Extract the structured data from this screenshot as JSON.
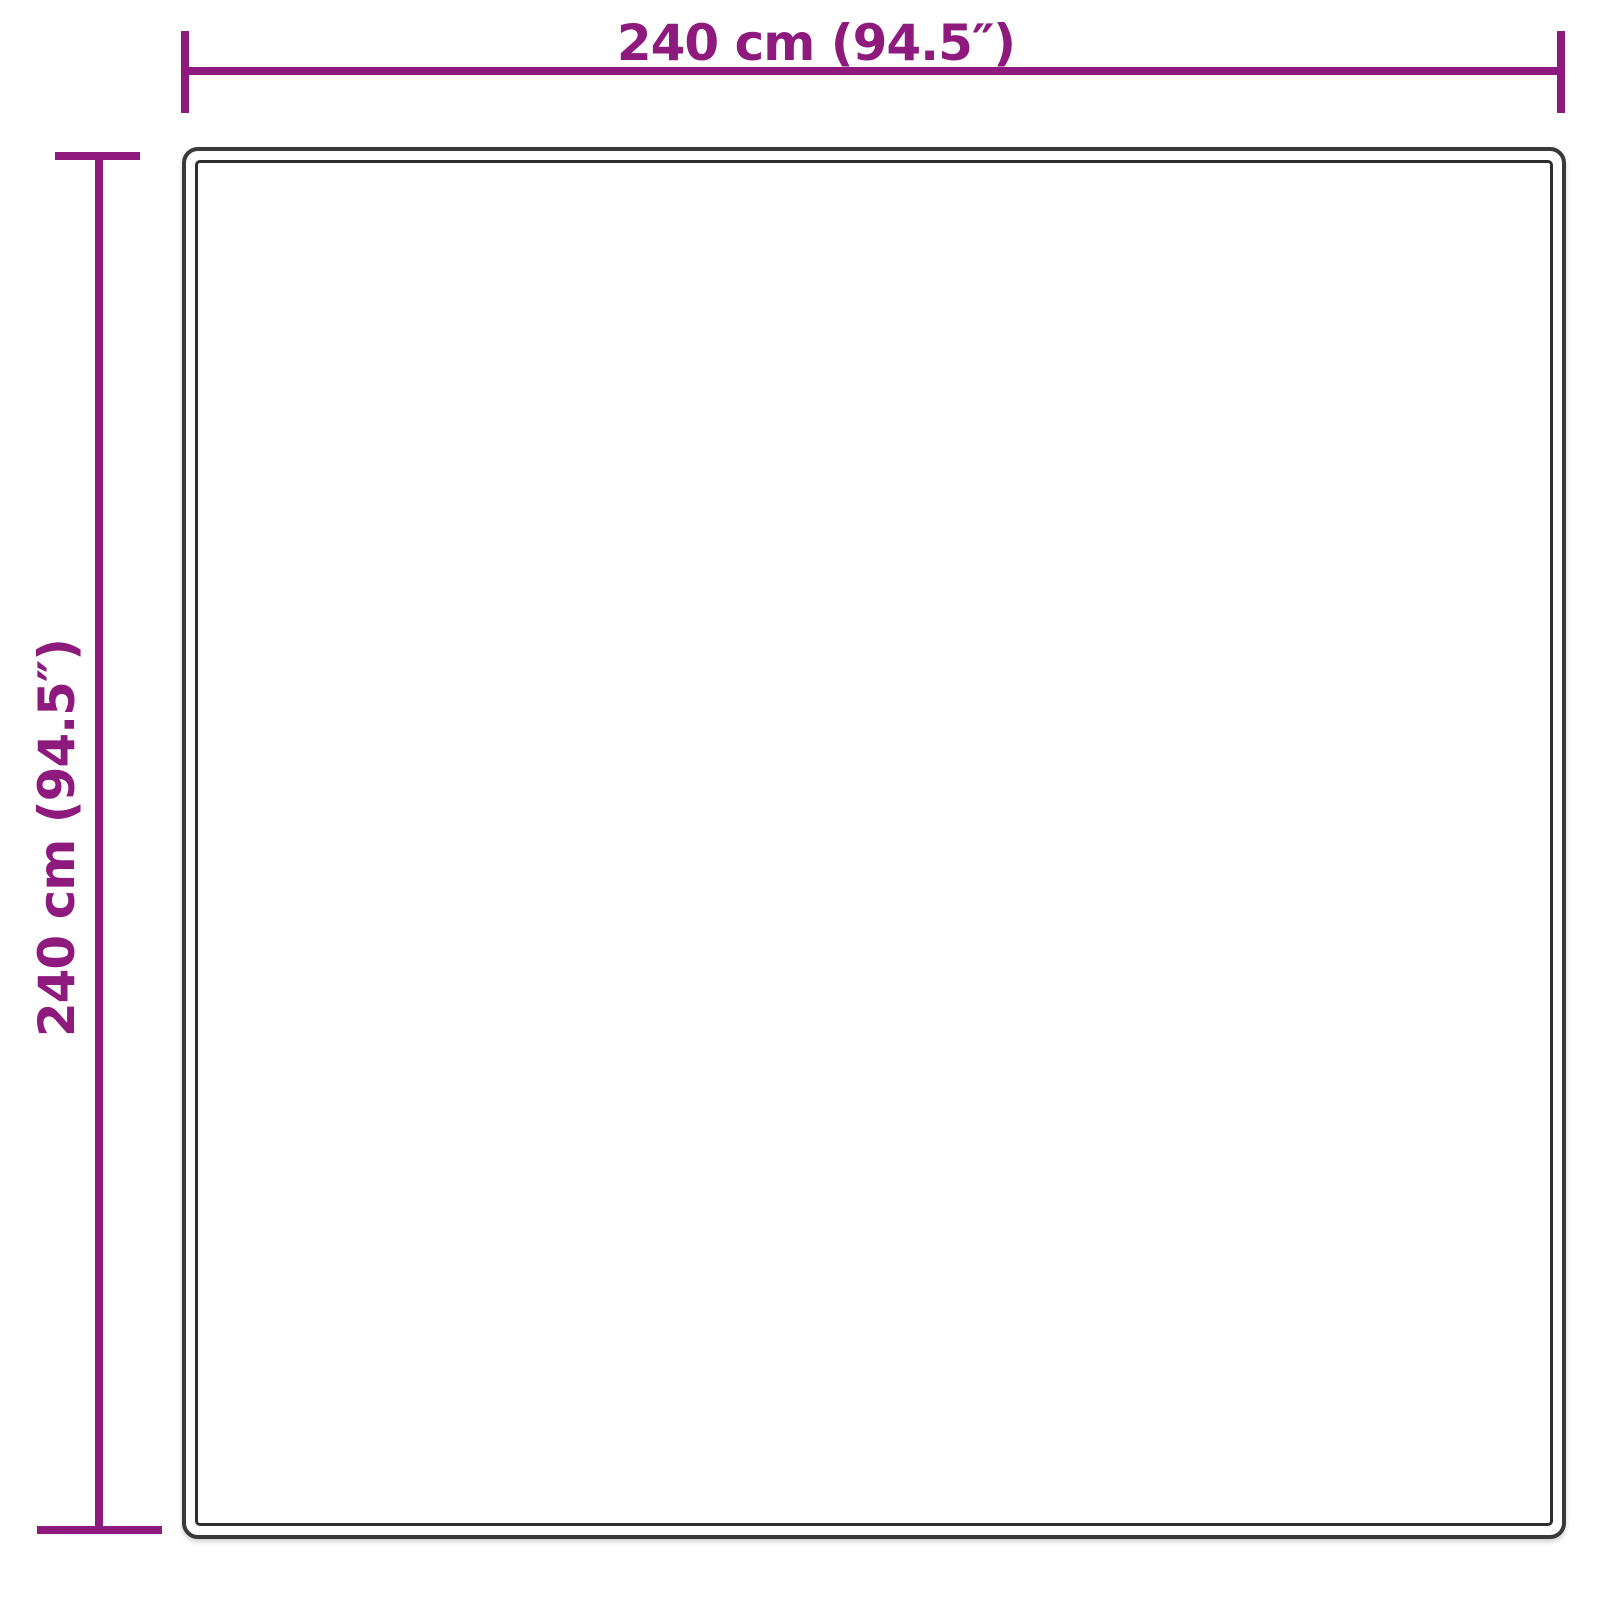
{
  "diagram": {
    "type": "product-dimension-diagram",
    "width_label": "240 cm (94.5″)",
    "height_label": "240 cm (94.5″)",
    "width_cm": 240,
    "height_cm": 240,
    "width_inches": 94.5,
    "height_inches": 94.5,
    "accent_color": "#8E1A7D",
    "outline_color": "#3A3A3A",
    "background_color": "#FFFFFF"
  }
}
